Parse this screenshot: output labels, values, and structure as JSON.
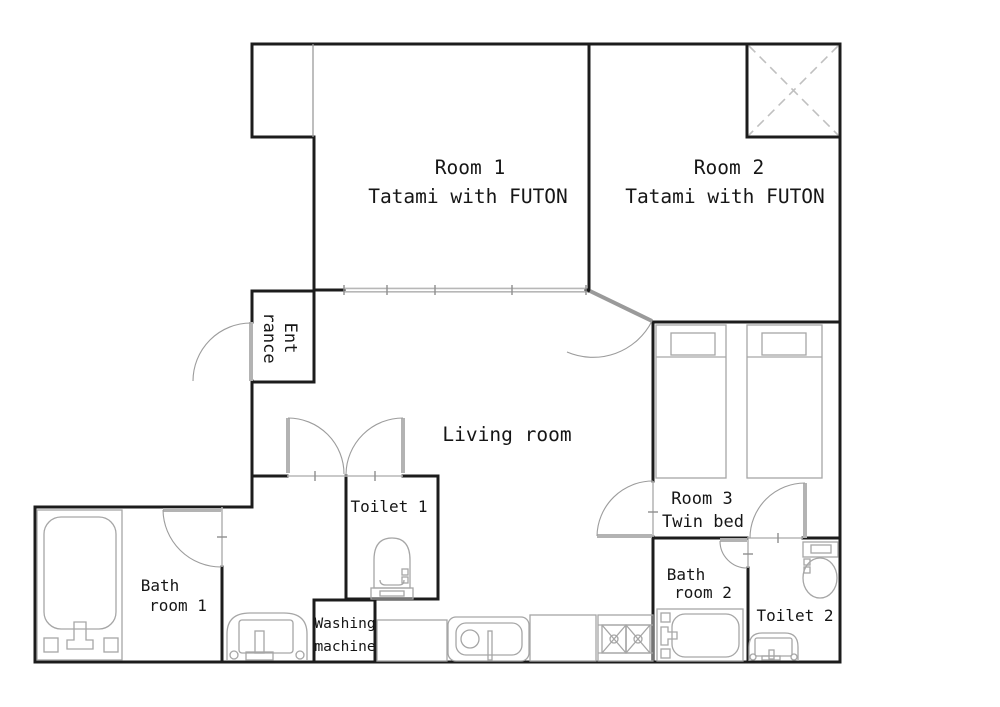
{
  "floorplan": {
    "labels": {
      "room1_title": "Room 1",
      "room1_sub": "Tatami with FUTON",
      "room2_title": "Room 2",
      "room2_sub": "Tatami with FUTON",
      "room3_title": "Room 3",
      "room3_sub": "Twin bed",
      "living": "Living room",
      "entrance_line1": "Ent",
      "entrance_line2": "rance",
      "toilet1": "Toilet 1",
      "toilet2": "Toilet 2",
      "bath1_line1": "Bath",
      "bath1_line2": "room 1",
      "bath2_line1": "Bath",
      "bath2_line2": "room 2",
      "washing_line1": "Washing",
      "washing_line2": "machine"
    },
    "colors": {
      "wall": "#1c1c1c",
      "thin_line": "#9b9b9b",
      "door": "#b3b3b3",
      "fixture": "#a6a6a6",
      "closet_x": "#c0c0c0",
      "text": "#161616",
      "background": "#ffffff"
    }
  }
}
